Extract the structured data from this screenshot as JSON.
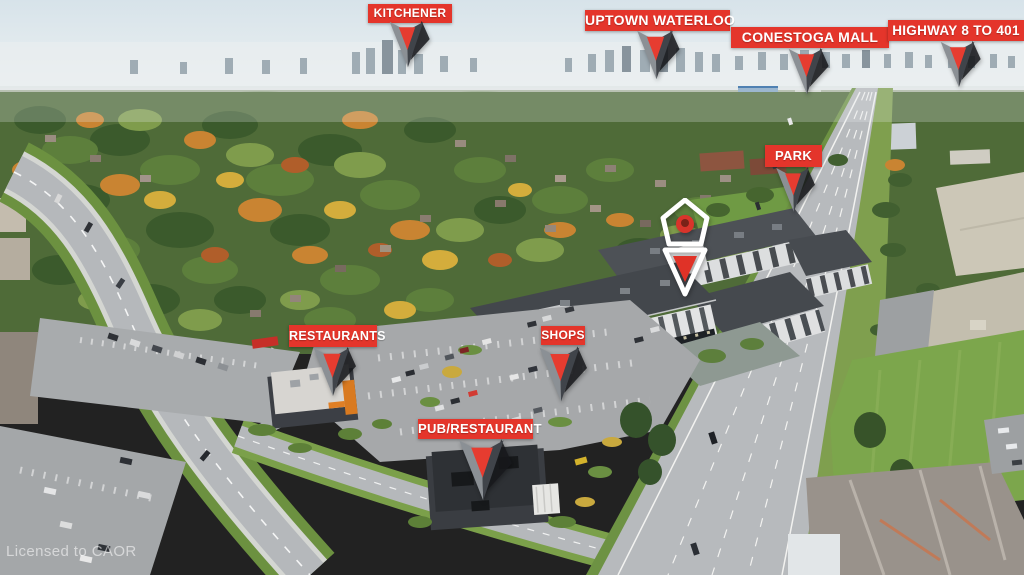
{
  "watermark": "Licensed to CAOR",
  "colors": {
    "label_bg": "#e4352b",
    "label_text": "#ffffff",
    "arrow_red": "#e63c30",
    "pin_red": "#e03227"
  },
  "markers": {
    "kitchener": {
      "label": "KITCHENER"
    },
    "uptown_waterloo": {
      "label": "UPTOWN WATERLOO"
    },
    "conestoga_mall": {
      "label": "CONESTOGA MALL"
    },
    "highway_8_to_401": {
      "label": "HIGHWAY 8 TO 401"
    },
    "park": {
      "label": "PARK"
    },
    "restaurants": {
      "label": "RESTAURANTS"
    },
    "shops": {
      "label": "SHOPS"
    },
    "pub_restaurant": {
      "label": "PUB/RESTAURANT"
    }
  }
}
